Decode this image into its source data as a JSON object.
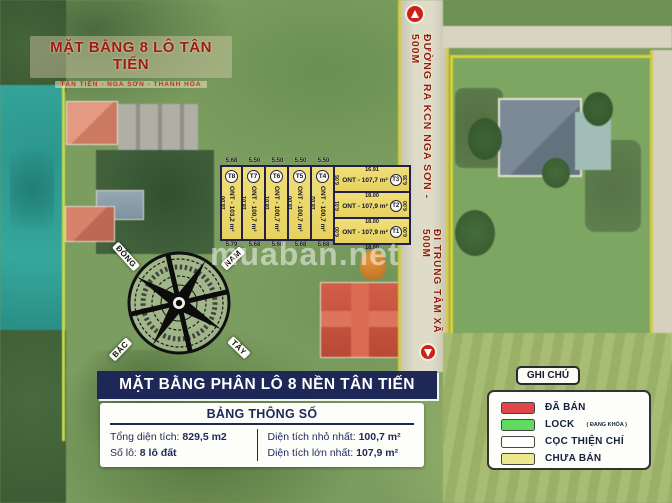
{
  "banner": {
    "title": "MẶT BẰNG 8 LÔ TÂN TIẾN",
    "subtitle": "TÂN TIẾN - NGA SƠN - THANH HÓA"
  },
  "roads": {
    "top": "ĐƯỜNG RA KCN NGA SƠN - 500M",
    "bottom": "ĐI TRUNG TÂM XÃ 500M"
  },
  "watermark": "muaban.net",
  "compass": {
    "labels": [
      "ĐÔNG",
      "NAM",
      "BẮC",
      "TÂY"
    ]
  },
  "plan": {
    "vertical_lots": [
      {
        "id": "T8",
        "area": "ONT - 103,2 m²",
        "top": "5.68",
        "bottom": "5.79",
        "side": "18.00"
      },
      {
        "id": "T7",
        "area": "ONT - 100,7 m²",
        "top": "5.50",
        "bottom": "5.68",
        "side": "18.01"
      },
      {
        "id": "T6",
        "area": "ONT - 100,7 m²",
        "top": "5.50",
        "bottom": "5.68",
        "side": "18.01"
      },
      {
        "id": "T5",
        "area": "ONT - 100,7 m²",
        "top": "5.50",
        "bottom": "5.68",
        "side": "18.00"
      },
      {
        "id": "T4",
        "area": "ONT - 100,7 m²",
        "top": "5.50",
        "bottom": "5.68",
        "side": "18.02"
      }
    ],
    "horizontal_lots": [
      {
        "id": "T3",
        "area": "ONT - 107,7 m²",
        "top": "16.91",
        "left": "6.05",
        "right": "6.35"
      },
      {
        "id": "T2",
        "area": "ONT - 107,9 m²",
        "top": "18.00",
        "left": "6.01",
        "right": "6.00"
      },
      {
        "id": "T1",
        "area": "ONT - 107,9 m²",
        "top": "18.00",
        "left": "6.00",
        "right": "6.00",
        "bottom": "18.00"
      }
    ]
  },
  "footer": {
    "title": "MẶT BẰNG PHÂN LÔ 8 NỀN TÂN TIẾN"
  },
  "spec": {
    "title": "BẢNG THÔNG SỐ",
    "left": [
      {
        "label": "Tổng diện tích: ",
        "value": "829,5 m2"
      },
      {
        "label": "Số lô: ",
        "value": "8 lô đất"
      }
    ],
    "right": [
      {
        "label": "Diện tích nhỏ nhất: ",
        "value": "100,7 m²"
      },
      {
        "label": "Diện tích lớn nhất: ",
        "value": "107,9 m²"
      }
    ]
  },
  "legend": {
    "title": "GHI CHÚ",
    "items": [
      {
        "label": "ĐÃ BÁN",
        "color": "#e0474a"
      },
      {
        "label": "LOCK",
        "suffix": "( ĐANG KHÓA )",
        "color": "#5ddc5d"
      },
      {
        "label": "CỌC THIỆN CHÍ",
        "color": "#ffffff"
      },
      {
        "label": "CHƯA BÁN",
        "color": "#ede88f"
      }
    ]
  }
}
